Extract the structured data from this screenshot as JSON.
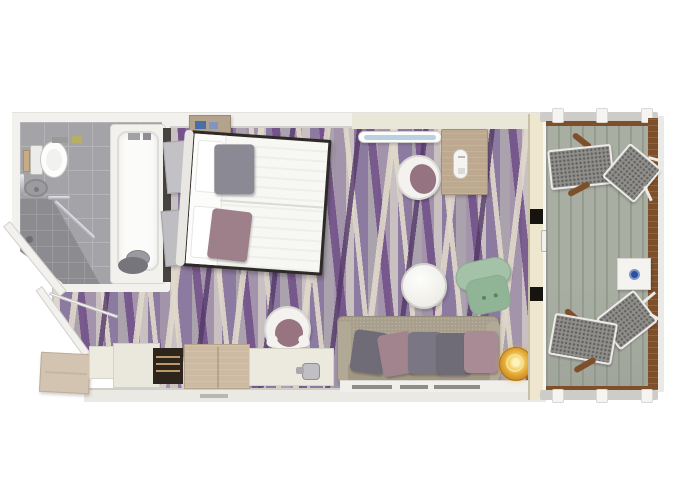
{
  "meta": {
    "title": "Stateroom floor plan with balcony",
    "type": "floor-plan"
  },
  "palette": {
    "wall": "#f2f1ee",
    "wall-edge": "#d2d1cd",
    "wall-desk": "#e9e8d8",
    "tile": "#a4a4a8",
    "tile-line": "#b4b4b8",
    "shower": "#8c8c90",
    "dark-wall": "#47433f",
    "carpet-base": "#a394ab",
    "carpet-light": "#c9c0c2",
    "carpet-mid": "#8d7aa0",
    "carpet-gray": "#aaa2ad",
    "carpet-purple": "rgba(111,77,134,0.85)",
    "carpet-deep": "rgba(84,56,104,0.8)",
    "carpet-cream": "rgba(224,216,202,0.9)",
    "wood": "#bca98f",
    "wood-dark": "#a2907a",
    "cab-wood": "#ccbba2",
    "cream": "#eceade",
    "deck": "#a9aea3",
    "deck-line": "#878c7f",
    "rail-wood": "#7d4f2b",
    "rail-gray": "#cdccc8",
    "mesh": "#908f8c",
    "mesh-dot": "#63625f",
    "frame-white": "#ecebe7",
    "bed-frame": "#2e2a27",
    "duvet": "#f7f7f4",
    "silver": "#c9c9cf",
    "sofa": "#a79e8c",
    "gold": "#e0a433",
    "green": "#a3c2a8",
    "green-dark": "#8cab91",
    "blue": "#2c4f9e",
    "white-obj": "#f3f2ee",
    "chair-cushion": "#97747f",
    "minibar": "#2c241d",
    "minibar-shelf": "#bb9a64"
  },
  "rooms": {
    "bathroom": {
      "label": "Bathroom",
      "items": [
        "toilet",
        "washbasin",
        "bathtub",
        "shower",
        "grab-bars",
        "bath-mat"
      ]
    },
    "cabin": {
      "label": "Stateroom",
      "items": [
        "double-bed",
        "nightstands",
        "headboard-shelf",
        "desk",
        "desk-chair",
        "wall-shelf",
        "round-side-table",
        "green-armchair",
        "sofa",
        "gold-ottoman",
        "vanity-chair",
        "cabinets",
        "minibar",
        "counter-with-kettle"
      ]
    },
    "entry": {
      "label": "Entry hall",
      "items": [
        "entry-door"
      ]
    },
    "balcony": {
      "label": "Balcony",
      "items": [
        "deck-planks",
        "lounge-chairs",
        "side-chairs",
        "side-table",
        "railing",
        "sliding-door"
      ]
    }
  },
  "bed": {
    "pillow_colors": [
      "#8b8a94",
      "#9d8089"
    ]
  },
  "sofa": {
    "pillow_colors": [
      "#6f6b77",
      "#a1848e",
      "#7b7683",
      "#6f6b77",
      "#a98b95"
    ]
  },
  "balcony_table": {
    "dot_color": "#2c4f9e"
  }
}
